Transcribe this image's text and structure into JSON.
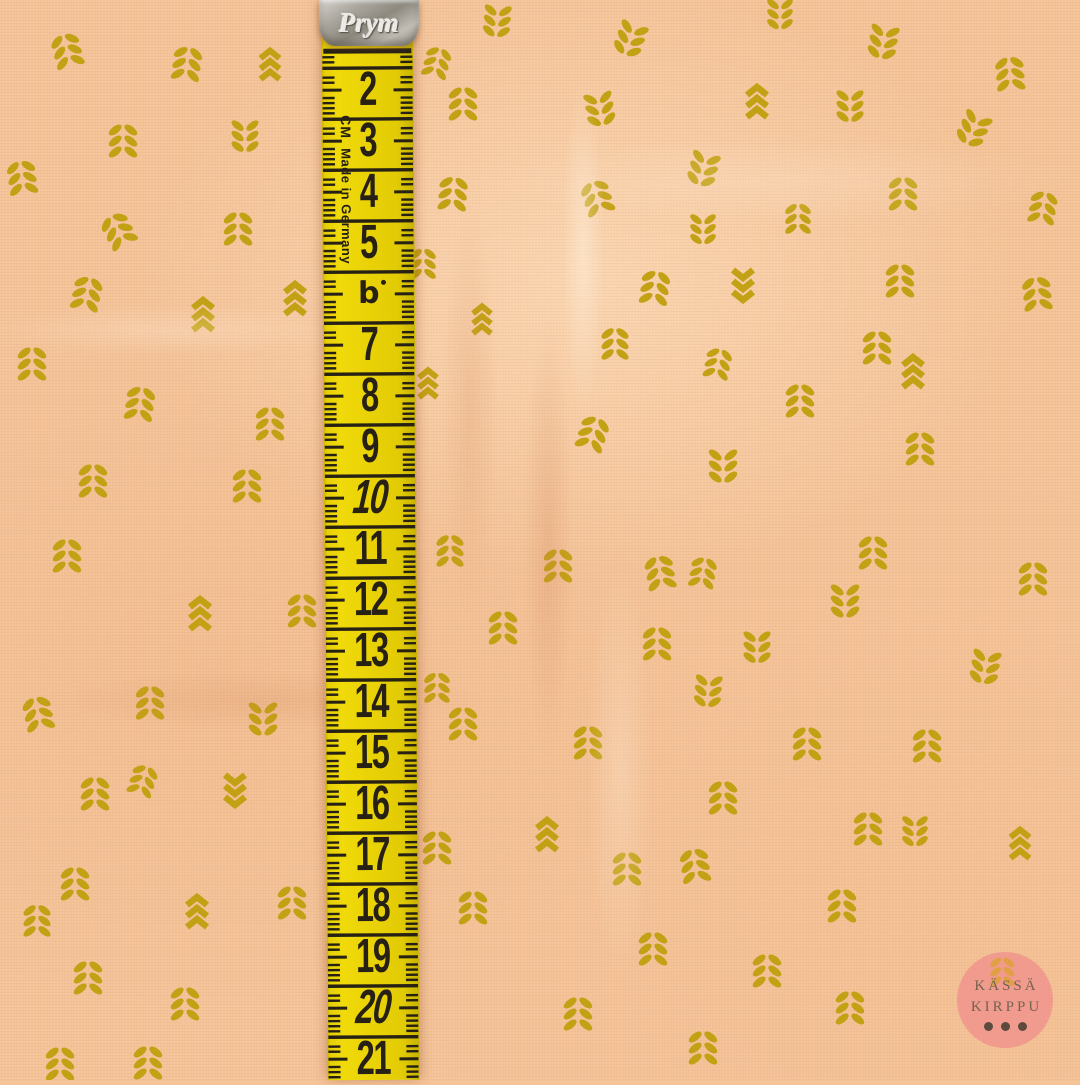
{
  "colors": {
    "fabric_base": "#f4c398",
    "motif": "#c3a115",
    "tape_yellow": "#e9d206",
    "tape_ink": "#262015",
    "clip_silver": "#a8a49c",
    "watermark_circle": "#f09b8e",
    "watermark_text": "#75624f",
    "watermark_dots": "#5d4a3c",
    "watermark_wheat": "#dfa13e"
  },
  "tape": {
    "brand": "Prym",
    "unit_label": "CM",
    "origin_label": "Made in Germany",
    "b_mark": "b",
    "numbers": [
      "2",
      "3",
      "4",
      "5",
      "7",
      "8",
      "9",
      "10",
      "11",
      "12",
      "13",
      "14",
      "15",
      "16",
      "17",
      "18",
      "19",
      "20",
      "21"
    ],
    "italic_numbers": [
      "10",
      "20"
    ],
    "b_mark_slot_cm": 6,
    "first_number_cm": 2,
    "last_number_cm": 21,
    "px_per_cm": 51,
    "first_number_y": 90
  },
  "watermark": {
    "line1": "KÄSSÄ",
    "line2": "KIRPPU",
    "dots": 3
  },
  "pattern": {
    "format": [
      "x",
      "y",
      "type(l=leaf-sprig,c=chevron)",
      "rotation_deg",
      "scale"
    ],
    "motifs": [
      [
        67,
        50,
        "l",
        -15,
        1
      ],
      [
        187,
        63,
        "l",
        8,
        1
      ],
      [
        270,
        63,
        "c",
        0,
        0.95
      ],
      [
        497,
        22,
        "l",
        185,
        0.95
      ],
      [
        437,
        62,
        "l",
        15,
        0.9
      ],
      [
        463,
        103,
        "l",
        0,
        1
      ],
      [
        630,
        40,
        "l",
        200,
        1
      ],
      [
        780,
        15,
        "l",
        180,
        0.9
      ],
      [
        883,
        43,
        "l",
        190,
        1
      ],
      [
        1010,
        73,
        "l",
        -5,
        1
      ],
      [
        600,
        110,
        "l",
        170,
        1
      ],
      [
        757,
        100,
        "c",
        0,
        1
      ],
      [
        850,
        107,
        "l",
        180,
        0.95
      ],
      [
        973,
        130,
        "l",
        205,
        1
      ],
      [
        123,
        140,
        "l",
        0,
        1
      ],
      [
        245,
        137,
        "l",
        180,
        0.95
      ],
      [
        22,
        177,
        "l",
        -8,
        1
      ],
      [
        453,
        193,
        "l",
        5,
        1
      ],
      [
        703,
        170,
        "l",
        195,
        1
      ],
      [
        597,
        197,
        "l",
        -18,
        1
      ],
      [
        903,
        193,
        "l",
        0,
        1
      ],
      [
        1043,
        207,
        "l",
        10,
        0.95
      ],
      [
        118,
        230,
        "l",
        -28,
        1
      ],
      [
        238,
        228,
        "l",
        0,
        1
      ],
      [
        703,
        230,
        "l",
        180,
        0.9
      ],
      [
        798,
        218,
        "l",
        0,
        0.9
      ],
      [
        423,
        263,
        "l",
        0,
        0.9
      ],
      [
        87,
        293,
        "l",
        12,
        1
      ],
      [
        295,
        297,
        "c",
        0,
        1
      ],
      [
        203,
        313,
        "c",
        0,
        1
      ],
      [
        655,
        287,
        "l",
        8,
        1
      ],
      [
        743,
        287,
        "c",
        180,
        1
      ],
      [
        900,
        280,
        "l",
        0,
        1
      ],
      [
        1037,
        293,
        "l",
        -6,
        1
      ],
      [
        482,
        318,
        "c",
        0,
        0.9
      ],
      [
        32,
        363,
        "l",
        0,
        1
      ],
      [
        615,
        343,
        "l",
        0,
        0.95
      ],
      [
        877,
        347,
        "l",
        0,
        1
      ],
      [
        718,
        363,
        "l",
        12,
        0.9
      ],
      [
        913,
        370,
        "c",
        0,
        1
      ],
      [
        140,
        403,
        "l",
        8,
        1
      ],
      [
        270,
        423,
        "l",
        0,
        1
      ],
      [
        428,
        382,
        "c",
        0,
        0.9
      ],
      [
        800,
        400,
        "l",
        0,
        1
      ],
      [
        593,
        433,
        "l",
        18,
        1
      ],
      [
        920,
        448,
        "l",
        0,
        1
      ],
      [
        93,
        480,
        "l",
        0,
        1
      ],
      [
        247,
        485,
        "l",
        0,
        1
      ],
      [
        723,
        467,
        "l",
        180,
        1
      ],
      [
        67,
        555,
        "l",
        0,
        1
      ],
      [
        450,
        550,
        "l",
        0,
        0.95
      ],
      [
        558,
        565,
        "l",
        0,
        1
      ],
      [
        660,
        572,
        "l",
        -10,
        1
      ],
      [
        703,
        572,
        "l",
        10,
        0.9
      ],
      [
        873,
        552,
        "l",
        0,
        1
      ],
      [
        1033,
        578,
        "l",
        0,
        1
      ],
      [
        200,
        612,
        "c",
        0,
        1
      ],
      [
        302,
        610,
        "l",
        0,
        1
      ],
      [
        503,
        627,
        "l",
        0,
        1
      ],
      [
        845,
        602,
        "l",
        180,
        1
      ],
      [
        985,
        668,
        "l",
        190,
        1
      ],
      [
        657,
        643,
        "l",
        0,
        1
      ],
      [
        757,
        648,
        "l",
        180,
        0.95
      ],
      [
        708,
        692,
        "l",
        185,
        0.95
      ],
      [
        38,
        713,
        "l",
        -12,
        1
      ],
      [
        150,
        702,
        "l",
        0,
        1
      ],
      [
        263,
        720,
        "l",
        180,
        1
      ],
      [
        437,
        687,
        "l",
        0,
        0.9
      ],
      [
        463,
        723,
        "l",
        0,
        1
      ],
      [
        588,
        742,
        "l",
        0,
        1
      ],
      [
        807,
        743,
        "l",
        0,
        1
      ],
      [
        927,
        745,
        "l",
        0,
        1
      ],
      [
        95,
        793,
        "l",
        0,
        1
      ],
      [
        143,
        780,
        "l",
        18,
        0.9
      ],
      [
        235,
        792,
        "c",
        180,
        1
      ],
      [
        723,
        797,
        "l",
        0,
        1
      ],
      [
        868,
        828,
        "l",
        0,
        1
      ],
      [
        915,
        832,
        "l",
        180,
        0.9
      ],
      [
        547,
        833,
        "c",
        0,
        1
      ],
      [
        1020,
        842,
        "c",
        0,
        0.95
      ],
      [
        75,
        883,
        "l",
        0,
        1
      ],
      [
        197,
        910,
        "c",
        0,
        1
      ],
      [
        292,
        902,
        "l",
        0,
        1
      ],
      [
        37,
        920,
        "l",
        0,
        0.95
      ],
      [
        627,
        868,
        "l",
        0,
        1
      ],
      [
        695,
        865,
        "l",
        -8,
        1
      ],
      [
        842,
        905,
        "l",
        0,
        1
      ],
      [
        437,
        847,
        "l",
        0,
        1
      ],
      [
        473,
        907,
        "l",
        0,
        1
      ],
      [
        88,
        977,
        "l",
        0,
        1
      ],
      [
        185,
        1003,
        "l",
        0,
        1
      ],
      [
        653,
        948,
        "l",
        0,
        1
      ],
      [
        767,
        970,
        "l",
        0,
        1
      ],
      [
        850,
        1007,
        "l",
        0,
        1
      ],
      [
        578,
        1013,
        "l",
        0,
        1
      ],
      [
        60,
        1063,
        "l",
        0,
        1
      ],
      [
        148,
        1062,
        "l",
        0,
        1
      ],
      [
        703,
        1047,
        "l",
        0,
        1
      ]
    ]
  }
}
